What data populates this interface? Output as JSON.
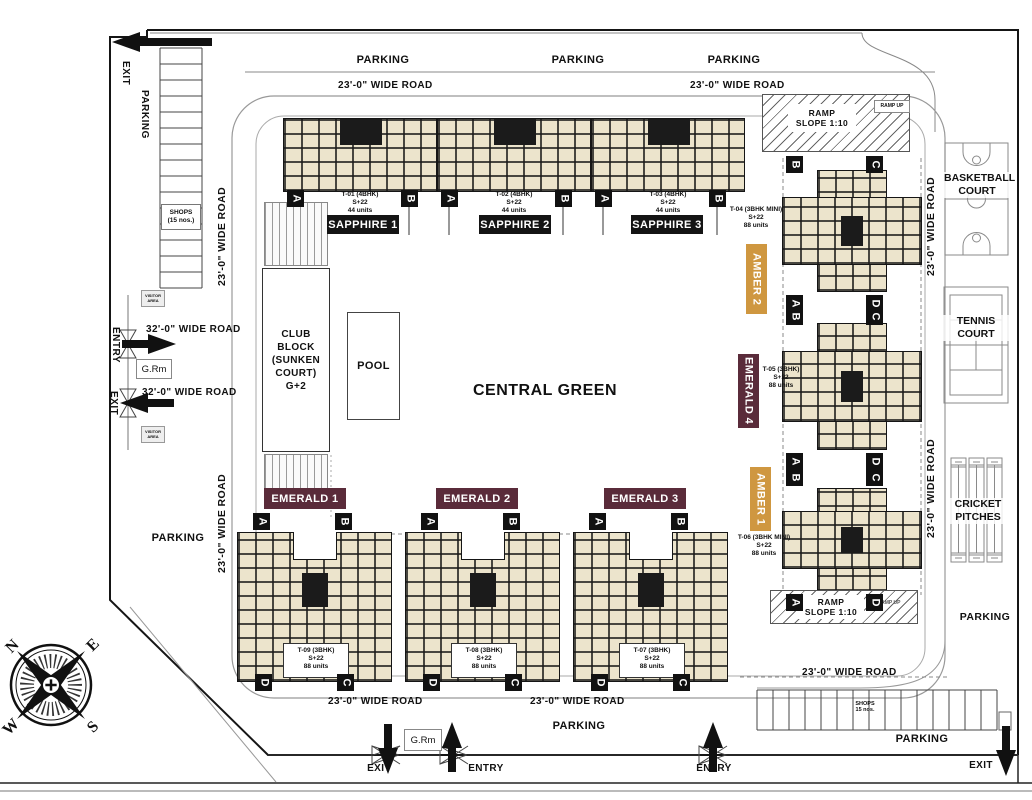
{
  "labels": {
    "parking": "PARKING",
    "entry": "ENTRY",
    "exit": "EXIT",
    "grm": "G.Rm",
    "visitor": "VISITOR AREA",
    "central_green": "CENTRAL GREEN",
    "club_block": "CLUB BLOCK (SUNKEN COURT) G+2",
    "pool": "POOL",
    "basketball": "BASKETBALL COURT",
    "tennis": "TENNIS COURT",
    "cricket": "CRICKET PITCHES",
    "ramp": "RAMP",
    "ramp_slope": "SLOPE 1:10",
    "ramp_up": "RAMP UP",
    "shops_left_1": "SHOPS",
    "shops_left_2": "(15 nos.)",
    "shops_right_1": "SHOPS",
    "shops_right_2": "15 nos."
  },
  "roads": {
    "w23": "23'-0\" WIDE ROAD",
    "w32": "32'-0\" WIDE ROAD"
  },
  "towers": {
    "sapphire1": {
      "label": "SAPPHIRE 1",
      "tower": "T-01 (4BHK)",
      "floors": "S+22",
      "units": "44 units"
    },
    "sapphire2": {
      "label": "SAPPHIRE 2",
      "tower": "T-02 (4BHK)",
      "floors": "S+22",
      "units": "44 units"
    },
    "sapphire3": {
      "label": "SAPPHIRE 3",
      "tower": "T-03 (4BHK)",
      "floors": "S+22",
      "units": "44 units"
    },
    "amber2": {
      "label": "AMBER 2",
      "tower": "T-04 (3BHK MINI)",
      "floors": "S+22",
      "units": "88 units"
    },
    "emerald4": {
      "label": "EMERALD 4",
      "tower": "T-05 (3BHK)",
      "floors": "S+22",
      "units": "88 units"
    },
    "amber1": {
      "label": "AMBER 1",
      "tower": "T-06 (3BHK MINI)",
      "floors": "S+22",
      "units": "88 units"
    },
    "emerald1": {
      "label": "EMERALD 1",
      "tower": "T-09 (3BHK)",
      "floors": "S+22",
      "units": "88 units"
    },
    "emerald2": {
      "label": "EMERALD 2",
      "tower": "T-08 (3BHK)",
      "floors": "S+22",
      "units": "88 units"
    },
    "emerald3": {
      "label": "EMERALD 3",
      "tower": "T-07 (3BHK)",
      "floors": "S+22",
      "units": "88 units"
    }
  },
  "markers": {
    "a": "A",
    "b": "B",
    "c": "C",
    "d": "D"
  },
  "compass": {
    "n": "N",
    "e": "E",
    "s": "S",
    "w": "W"
  },
  "colors": {
    "sapphire": "#141414",
    "emerald": "#5a2b3a",
    "amber": "#cf9740",
    "building": "#ece4cc"
  }
}
